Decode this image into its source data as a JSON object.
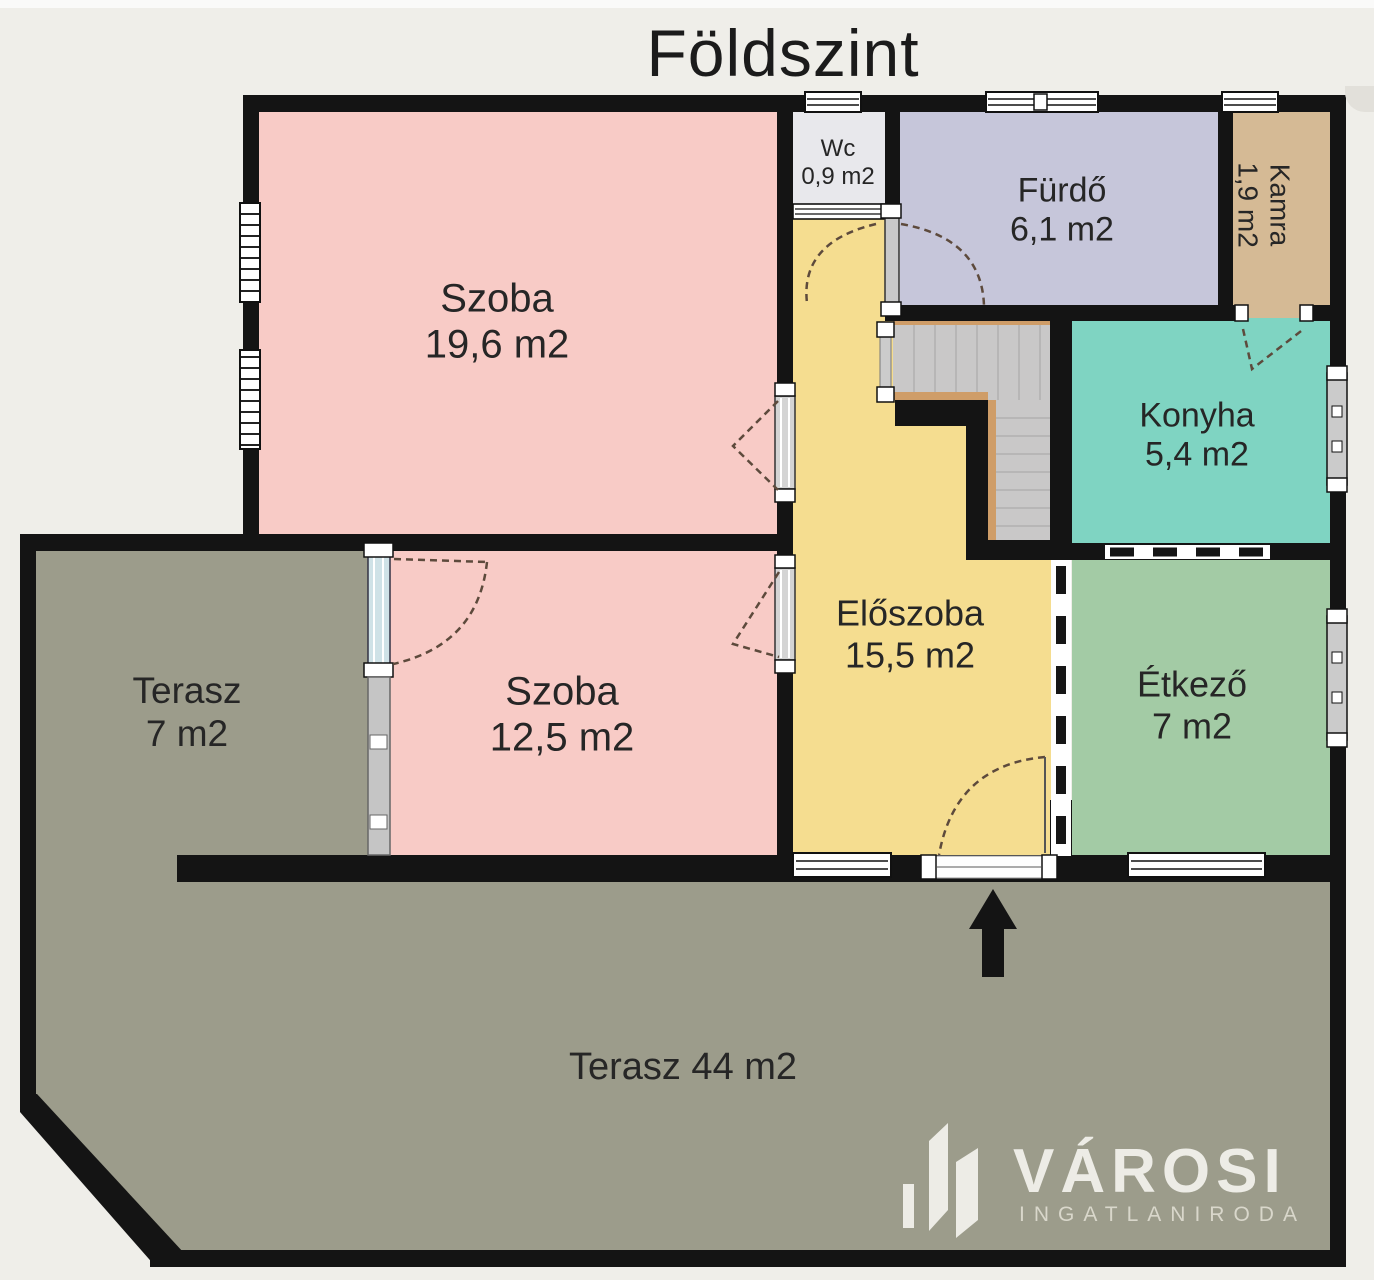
{
  "title": "Földszint",
  "rooms": {
    "szoba19": {
      "label": "Szoba",
      "area": "19,6 m2"
    },
    "szoba12": {
      "label": "Szoba",
      "area": "12,5 m2"
    },
    "wc": {
      "label": "Wc",
      "area": "0,9 m2"
    },
    "furdo": {
      "label": "Fürdő",
      "area": "6,1 m2"
    },
    "kamra": {
      "label": "Kamra",
      "area": "1,9 m2"
    },
    "konyha": {
      "label": "Konyha",
      "area": "5,4 m2"
    },
    "eloszoba": {
      "label": "Előszoba",
      "area": "15,5 m2"
    },
    "etkezo": {
      "label": "Étkező",
      "area": "7 m2"
    },
    "terasz_small": {
      "label": "Terasz",
      "area": "7 m2"
    },
    "terasz_large": {
      "label": "Terasz 44 m2"
    }
  },
  "branding": {
    "name": "VÁROSI",
    "subtitle": "INGATLANIRODA"
  },
  "icons": {
    "entrance_arrow": "up-arrow",
    "logo_mark": "buildings"
  },
  "colors": {
    "background": "#efeee9",
    "walls": "#141414",
    "room_pink": "#f8cbc6",
    "room_yellow": "#f5dd90",
    "room_lavender": "#c6c6da",
    "room_teal": "#7fd4c2",
    "room_green": "#a3cba5",
    "room_tan": "#d5ba95",
    "room_wc": "#e8e8ec",
    "terrace": "#9c9c8b",
    "stairs": "#c9c8c8",
    "stair_edge": "#cf9d68",
    "logo_text": "#edece6"
  }
}
